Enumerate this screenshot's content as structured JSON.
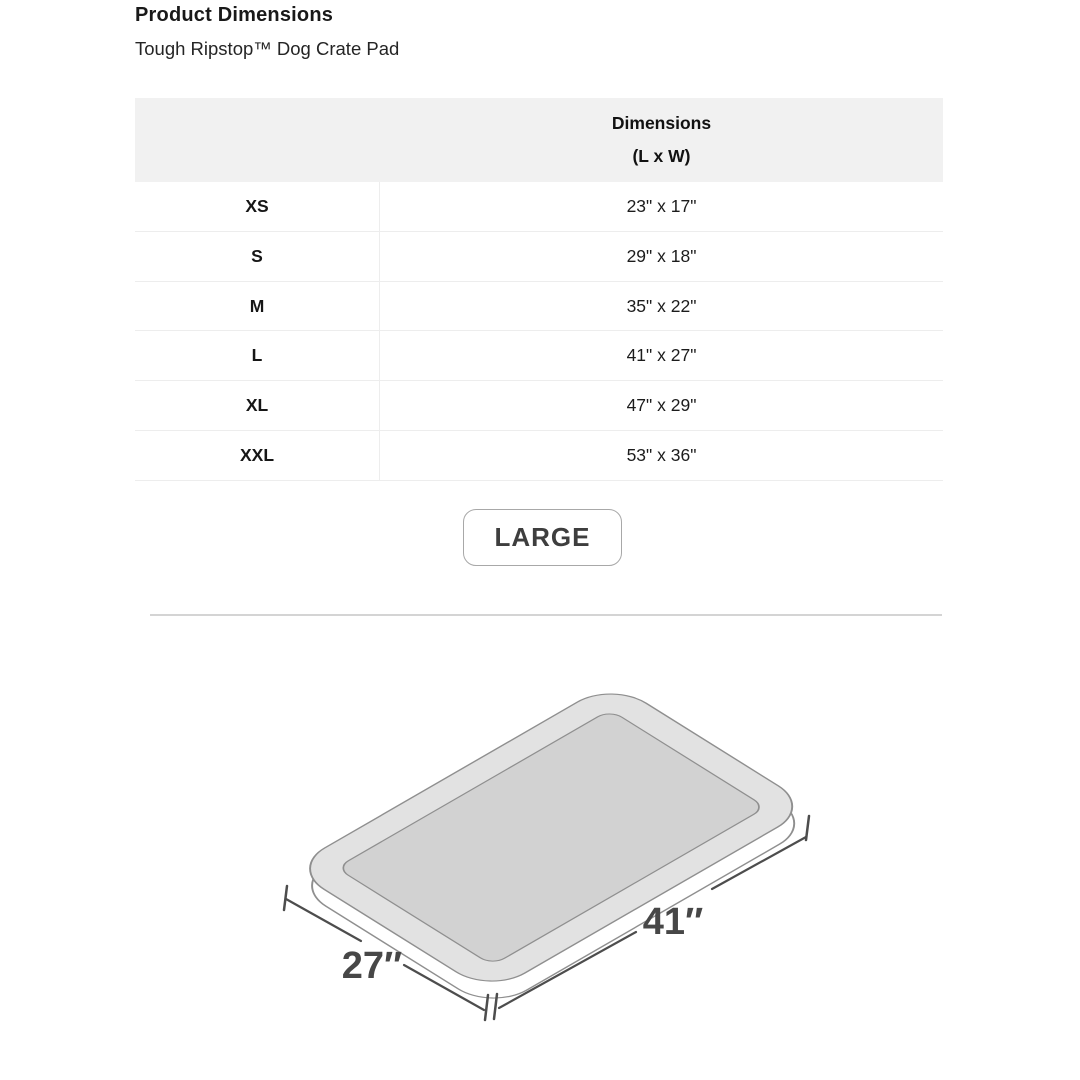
{
  "page": {
    "title": "Product Dimensions",
    "subtitle": "Tough Ripstop™ Dog Crate Pad"
  },
  "table": {
    "header_line1": "Dimensions",
    "header_line2": "(L x W)",
    "rows": [
      {
        "size": "XS",
        "dimensions": "23\" x 17\""
      },
      {
        "size": "S",
        "dimensions": "29\" x 18\""
      },
      {
        "size": "M",
        "dimensions": "35\" x 22\""
      },
      {
        "size": "L",
        "dimensions": "41\" x 27\""
      },
      {
        "size": "XL",
        "dimensions": "47\" x 29\""
      },
      {
        "size": "XXL",
        "dimensions": "53\" x 36\""
      }
    ]
  },
  "selected_size_button": {
    "label": "LARGE"
  },
  "diagram": {
    "length_label": "41″",
    "width_label": "27″",
    "pad_outer_color": "#e2e2e2",
    "pad_inner_color": "#d2d2d2",
    "pad_bottom_color": "#ffffff",
    "outline_color": "#8f8f8f",
    "dimension_line_color": "#4d4d4d",
    "label_color": "#474747"
  }
}
